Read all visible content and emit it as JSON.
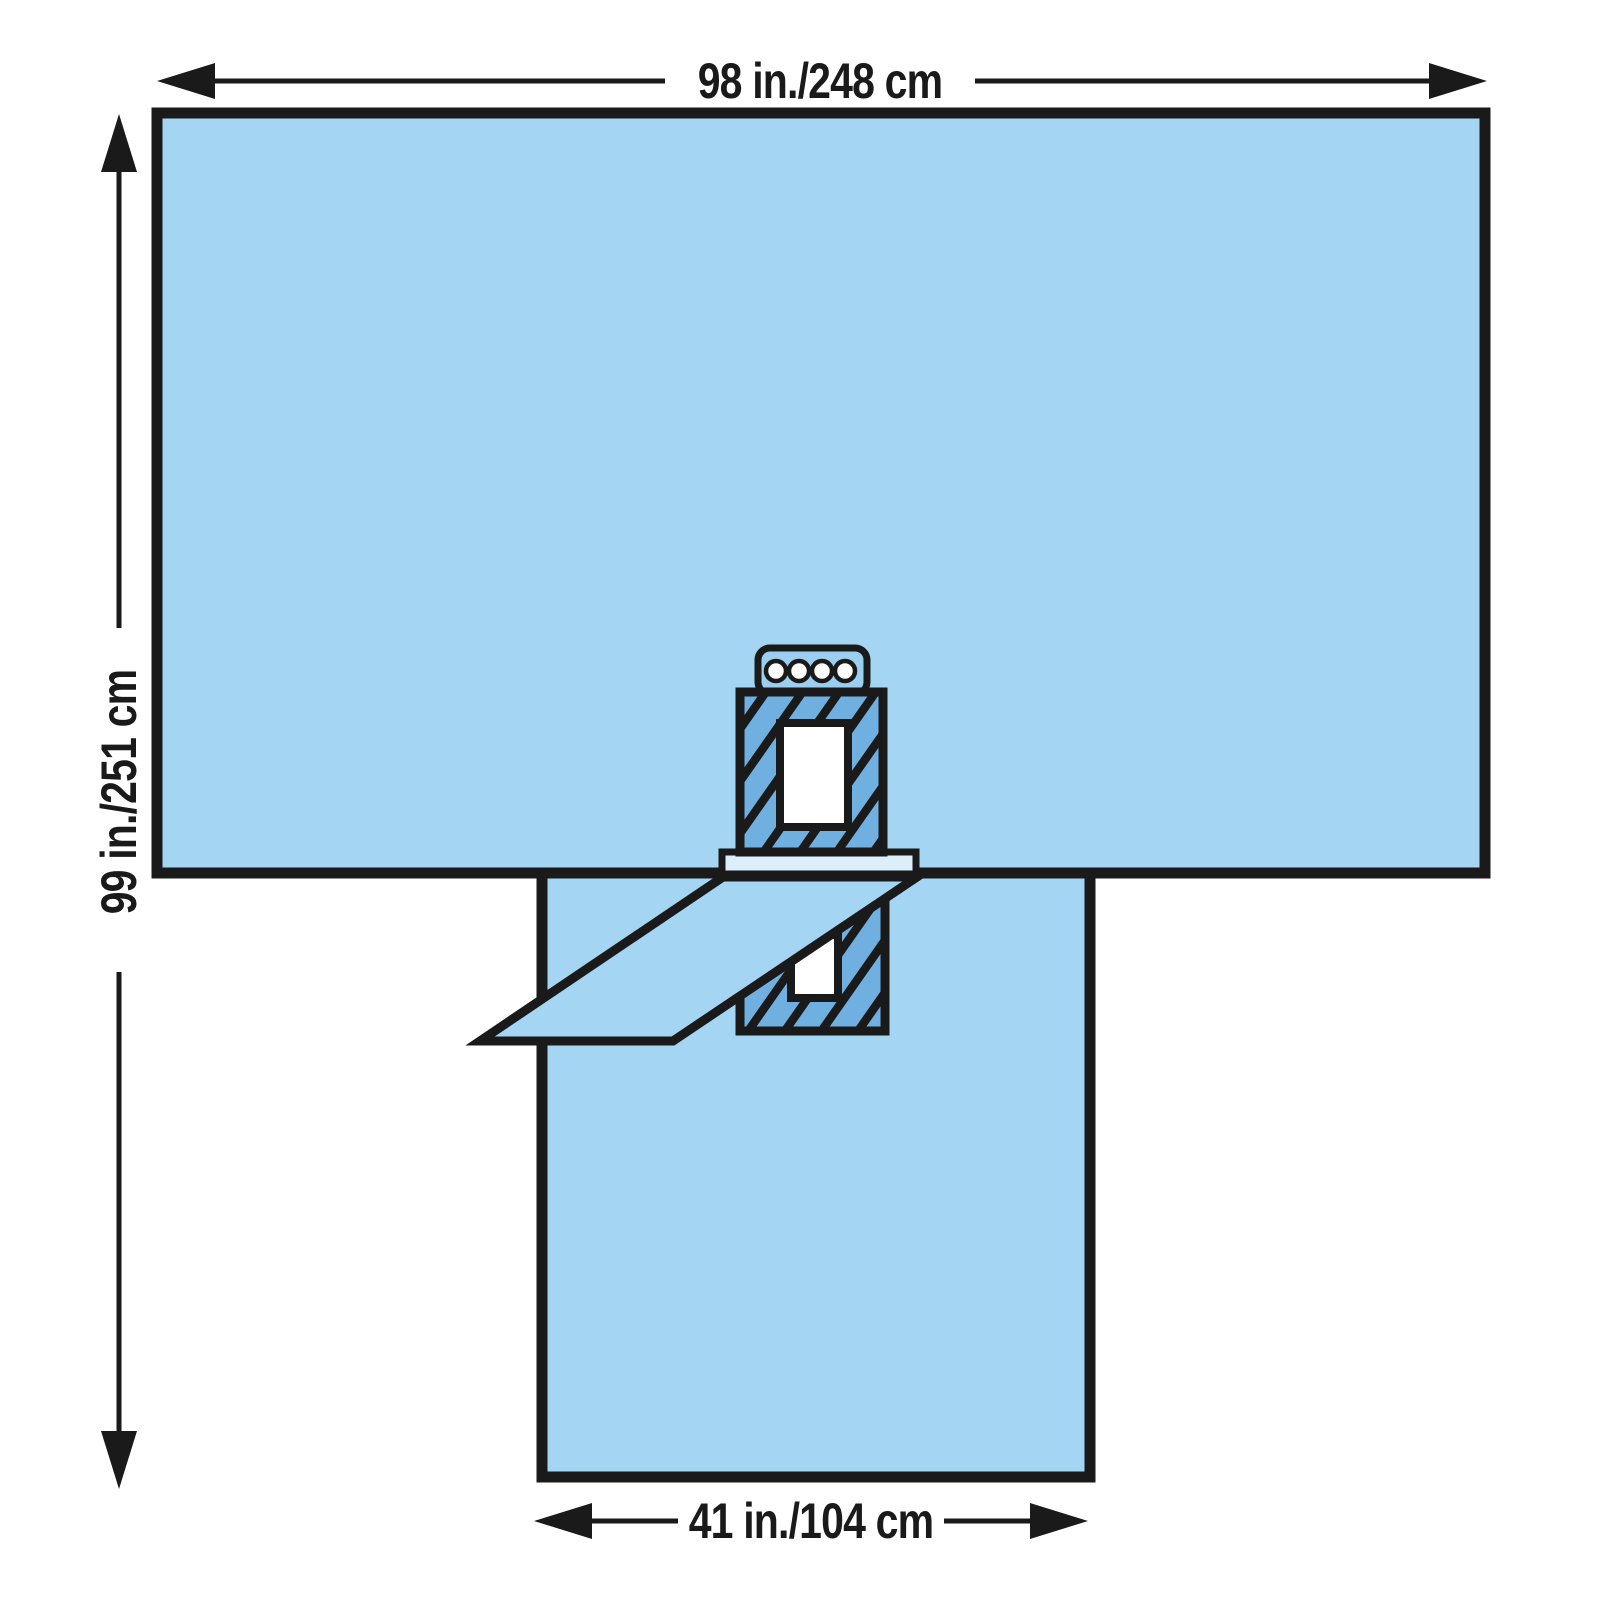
{
  "figure": {
    "kind": "product-dimension-diagram",
    "subject": "T-shaped surgical drape with fenestration, adhesive aperture zones, tube organizer and fold-out flap"
  },
  "dimensions": {
    "top_width_label": "98 in./248 cm",
    "left_height_label": "99 in./251 cm",
    "bottom_width_label": "41 in./104 cm"
  },
  "colors": {
    "background": "#FFFFFF",
    "outline": "#1A1A1A",
    "drape": "#A4D5F3",
    "hatch_fill": "#6FB0E0",
    "hatch_line": "#1A1A1A",
    "aperture": "#FFFFFF",
    "bar": "#DCEEFA",
    "holder": "#9CCEF0",
    "hole": "#FFFFFF"
  },
  "features": {
    "main_panel": "upper drape panel",
    "leg_panel": "lower drape leg panel",
    "upper_incise_area": "hatched adhesive incise area (upper)",
    "upper_aperture": "fenestration opening (upper)",
    "lower_incise_area": "hatched adhesive incise area (lower)",
    "lower_aperture": "fenestration opening (lower)",
    "flap": "fold-back flap",
    "bar": "reinforcement strip",
    "tube_holder": "tube/line organizer with four holes"
  }
}
